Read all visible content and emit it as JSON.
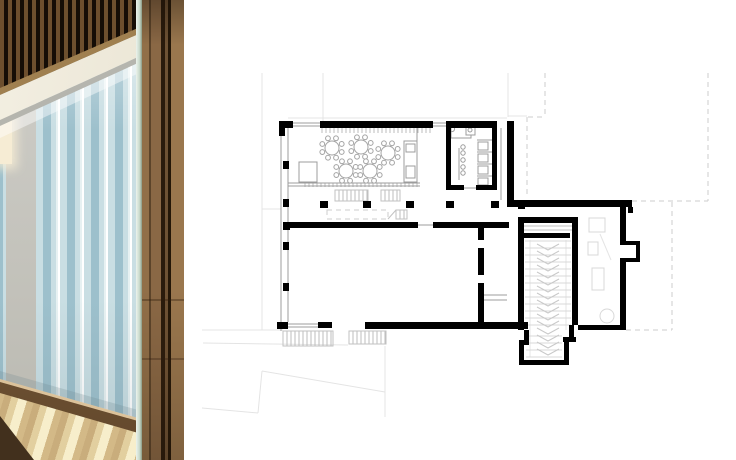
{
  "panels": {
    "left": "interior-photo",
    "right": "ground-floor-plan"
  },
  "theme": {
    "--bg": "#ffffff",
    "--curtain-d": "#9dc0cc",
    "--curtain-m": "#c9dee3",
    "--curtain-l": "#e7f1f2",
    "--concrete": "#cbcac4",
    "--slat-dark": "#150d06",
    "--slat-light": "#6d4f2e",
    "--cream": "#f3efe2",
    "--rail": "#b5b5ae",
    "--sill": "#8a6a44",
    "--sill-hi": "#dcc29a",
    "--floor-a": "#c9ad7c",
    "--floor-b": "#e2cf9f",
    "--floor-c": "#f7eecb",
    "--floor-shadow": "#42301d",
    "--wood-1": "#916f48",
    "--wood-2": "#5c442a",
    "--wood-3": "#8a6845",
    "--wood-4": "#2a1b0c",
    "--wood-5": "#6e5234",
    "--wood-6": "#241708",
    "--wood-7": "#9a774e",
    "--glass-1": "#ecf3ec",
    "--glass-2": "#c8d9cb",
    "--glass-3": "#8a9a84"
  },
  "plan": {
    "styles": {
      "wall": "#000000",
      "thin": "#9c9c9c",
      "med": "#c2c2c2",
      "faint": "#e4e4e4",
      "dash": "#cdcdcd",
      "hatch": "#bdbdbd",
      "furn": "#a3a3a3",
      "furnFaint": "#d8d8d8",
      "tread": "#d8d8d8",
      "chev": "#c9c9c9",
      "fill": "#ffffff"
    },
    "walls": [
      [
        279,
        121,
        14,
        7
      ],
      [
        279,
        121,
        6,
        15
      ],
      [
        320,
        121,
        113,
        7
      ],
      [
        446,
        121,
        51,
        7
      ],
      [
        446,
        121,
        5,
        69
      ],
      [
        492,
        121,
        5,
        69
      ],
      [
        446,
        185,
        18,
        5
      ],
      [
        476,
        185,
        21,
        5
      ],
      [
        507,
        121,
        7,
        83
      ],
      [
        507,
        200,
        125,
        7
      ],
      [
        628,
        207,
        5,
        6
      ],
      [
        620,
        207,
        6,
        36
      ],
      [
        620,
        241,
        20,
        4
      ],
      [
        636,
        241,
        4,
        21
      ],
      [
        620,
        258,
        20,
        4
      ],
      [
        620,
        262,
        6,
        68
      ],
      [
        578,
        325,
        48,
        5
      ],
      [
        283,
        222,
        7,
        8
      ],
      [
        288,
        222,
        130,
        6
      ],
      [
        433,
        222,
        76,
        6
      ],
      [
        518,
        203,
        7,
        6
      ],
      [
        523,
        217,
        55,
        6
      ],
      [
        572,
        217,
        6,
        12
      ],
      [
        523,
        233,
        47,
        5
      ],
      [
        518,
        217,
        6,
        113
      ],
      [
        572,
        217,
        6,
        108
      ],
      [
        478,
        222,
        6,
        18
      ],
      [
        478,
        248,
        6,
        27
      ],
      [
        478,
        283,
        6,
        44
      ],
      [
        277,
        322,
        11,
        7
      ],
      [
        318,
        322,
        14,
        6
      ],
      [
        365,
        322,
        163,
        7
      ],
      [
        524,
        330,
        5,
        12
      ],
      [
        519,
        340,
        10,
        5
      ],
      [
        519,
        344,
        5,
        21
      ],
      [
        519,
        360,
        50,
        5
      ],
      [
        564,
        342,
        5,
        20
      ],
      [
        563,
        337,
        13,
        5
      ],
      [
        569,
        325,
        5,
        14
      ],
      [
        283,
        161,
        6,
        8
      ],
      [
        283,
        199,
        6,
        8
      ],
      [
        283,
        242,
        6,
        8
      ],
      [
        283,
        283,
        6,
        8
      ],
      [
        320,
        201,
        8,
        7
      ],
      [
        363,
        201,
        8,
        7
      ],
      [
        406,
        201,
        8,
        7
      ],
      [
        446,
        201,
        8,
        7
      ],
      [
        491,
        201,
        8,
        7
      ]
    ],
    "lines": {
      "thin": [
        [
          281,
          121,
          281,
          331
        ],
        [
          288,
          128,
          288,
          322
        ],
        [
          288,
          123,
          320,
          123
        ],
        [
          288,
          126,
          320,
          126
        ],
        [
          433,
          123,
          446,
          123
        ],
        [
          433,
          126,
          446,
          126
        ],
        [
          288,
          183,
          420,
          183
        ],
        [
          288,
          186,
          420,
          186
        ],
        [
          417,
          127,
          417,
          183
        ],
        [
          418,
          225,
          433,
          225
        ],
        [
          464,
          188,
          477,
          188
        ],
        [
          501,
          128,
          501,
          200
        ],
        [
          288,
          324,
          318,
          324
        ],
        [
          288,
          327,
          318,
          327
        ],
        [
          483,
          295,
          507,
          295
        ],
        [
          483,
          300,
          507,
          300
        ],
        [
          477,
          140,
          492,
          140
        ],
        [
          477,
          152,
          492,
          152
        ],
        [
          477,
          164,
          492,
          164
        ],
        [
          477,
          176,
          492,
          176
        ],
        [
          459,
          148,
          459,
          180
        ]
      ],
      "med": [
        [
          524,
          226,
          572,
          226
        ],
        [
          524,
          230,
          572,
          230
        ],
        [
          388,
          219,
          396,
          210
        ]
      ],
      "faint": [
        [
          262,
          73,
          262,
          330
        ],
        [
          262,
          209,
          281,
          209
        ],
        [
          323,
          73,
          323,
          121
        ],
        [
          508,
          73,
          508,
          117
        ],
        [
          288,
          118,
          507,
          118
        ],
        [
          508,
          116,
          527,
          116
        ],
        [
          202,
          330,
          283,
          330
        ],
        [
          203,
          343,
          348,
          345
        ],
        [
          202,
          408,
          258,
          413
        ],
        [
          258,
          413,
          262,
          371
        ],
        [
          262,
          371,
          385,
          392
        ],
        [
          385,
          346,
          385,
          417
        ],
        [
          530,
          240,
          530,
          357
        ],
        [
          566,
          240,
          566,
          330
        ],
        [
          600,
          234,
          611,
          260
        ]
      ]
    },
    "dashed": [
      [
        545,
        73,
        545,
        117
      ],
      [
        528,
        117,
        545,
        117
      ],
      [
        527,
        117,
        527,
        197
      ],
      [
        708,
        73,
        708,
        201
      ],
      [
        632,
        201,
        708,
        201
      ],
      [
        672,
        202,
        672,
        330
      ],
      [
        626,
        330,
        672,
        330
      ]
    ],
    "dashedRects": [
      [
        327,
        210,
        61,
        9
      ]
    ],
    "outlineRects": {
      "thin": [
        [
          404,
          141,
          13,
          41
        ],
        [
          406,
          144,
          9,
          8
        ],
        [
          406,
          166,
          9,
          12
        ],
        [
          299,
          162,
          18,
          20
        ],
        [
          451,
          126,
          20,
          12
        ],
        [
          466,
          126,
          9,
          9
        ],
        [
          478,
          142,
          10,
          8
        ],
        [
          478,
          154,
          10,
          8
        ],
        [
          478,
          166,
          10,
          8
        ],
        [
          478,
          178,
          10,
          7
        ]
      ],
      "faint": [
        [
          589,
          218,
          16,
          14
        ],
        [
          588,
          242,
          10,
          13
        ],
        [
          592,
          268,
          12,
          22
        ]
      ]
    },
    "circlesThin": [
      [
        452,
        129,
        2.6
      ],
      [
        470,
        130,
        2
      ],
      [
        463,
        147,
        2.2
      ],
      [
        463,
        153,
        2.2
      ],
      [
        463,
        160,
        2.2
      ],
      [
        463,
        167,
        2.2
      ],
      [
        463,
        173,
        2.2
      ]
    ],
    "circlesFaint": [
      [
        607,
        316,
        7
      ]
    ],
    "hatches": [
      [
        322,
        128,
        111,
        5,
        4,
        0
      ],
      [
        305,
        183,
        115,
        4,
        4,
        0
      ],
      [
        335,
        190,
        33,
        11,
        4,
        1
      ],
      [
        381,
        190,
        19,
        11,
        4,
        1
      ],
      [
        396,
        210,
        11,
        9,
        4,
        1
      ],
      [
        283,
        331,
        50,
        15,
        4,
        1
      ],
      [
        349,
        331,
        37,
        13,
        4,
        1
      ]
    ],
    "tables": {
      "r": 7,
      "chairR": 2.4,
      "chairDist": 10.5,
      "chairs": 8,
      "centers": [
        [
          332,
          148
        ],
        [
          361,
          147
        ],
        [
          388,
          153
        ],
        [
          346,
          171
        ],
        [
          370,
          171
        ]
      ]
    },
    "treads": [
      {
        "x1": 525,
        "x2": 571,
        "y0": 241,
        "y1": 329,
        "step": 7
      },
      {
        "x1": 526,
        "x2": 562,
        "y0": 336,
        "y1": 357,
        "step": 7
      }
    ],
    "chevrons": {
      "xl": 537,
      "xc": 548,
      "xr": 559,
      "y0": 244,
      "y1": 354,
      "step": 7,
      "depth": 6
    }
  }
}
